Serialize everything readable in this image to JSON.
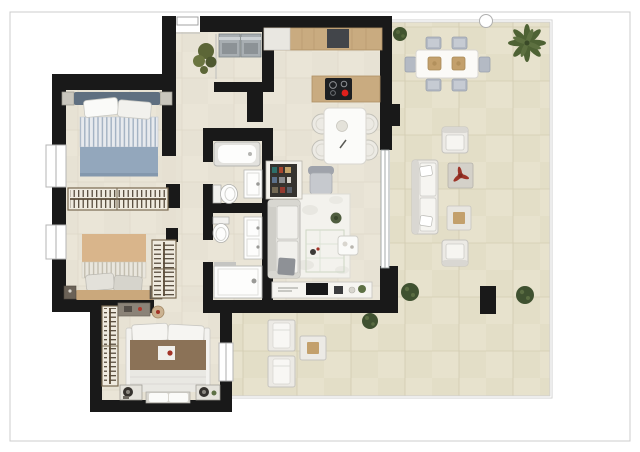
{
  "page": {
    "kind": "apartment-floor-plan-render",
    "background": "#ffffff",
    "frame_color": "#cccccc"
  },
  "palette": {
    "wall": "#191919",
    "indoor_floor": "#eae5d7",
    "terrace_floor": "#e7e2cd",
    "wood_counter": "#c9ab80",
    "wardrobe_wood": "#4a3e30",
    "bed_blue": "#93a7bc",
    "bed_blue_stripe": "#a3b2c3",
    "bed_tan": "#d9b58b",
    "bed_brown": "#8b7257",
    "fixture_white": "#fdfdfc",
    "furniture_gray": "#c6c9ce",
    "outdoor_white": "#eceae5",
    "plant_green": "#41542f",
    "plant_olive": "#5c6637",
    "accent_red": "#e0201c",
    "deco_red": "#9c3428",
    "appliance_gray": "#a8aeb2",
    "glass_line": "#9aa0a0",
    "balustrade": "#cfcfcf",
    "tv_black": "#17181a",
    "cooktop_black": "#1d1f22"
  },
  "plan": {
    "rooms": [
      {
        "id": "entry-hall",
        "items": [
          "entry-door",
          "potted-plant"
        ]
      },
      {
        "id": "utility-closet",
        "items": [
          "washer",
          "dryer"
        ]
      },
      {
        "id": "kitchen",
        "items": [
          "wall-counter",
          "sink-unit",
          "island-with-cooktop"
        ]
      },
      {
        "id": "dining-area",
        "items": [
          "table",
          "four-round-chairs",
          "armchair"
        ]
      },
      {
        "id": "living-room",
        "items": [
          "sofa",
          "rug",
          "side-table",
          "bookshelf",
          "tv-sideboard",
          "glass-sliding-door"
        ]
      },
      {
        "id": "bedroom-1",
        "items": [
          "double-bed-blue",
          "two-nightstands",
          "wardrobe",
          "window"
        ]
      },
      {
        "id": "bedroom-2",
        "items": [
          "double-bed-tan",
          "two-nightstands",
          "wardrobe",
          "window"
        ]
      },
      {
        "id": "master-bedroom",
        "items": [
          "double-bed-brown",
          "bench",
          "two-nightstands",
          "wardrobe",
          "desk",
          "stool",
          "window"
        ]
      },
      {
        "id": "bathroom-1",
        "items": [
          "bathtub",
          "washbasin",
          "toilet"
        ]
      },
      {
        "id": "bathroom-2",
        "items": [
          "shower",
          "washbasin",
          "toilet"
        ]
      },
      {
        "id": "terrace",
        "items": [
          "outdoor-dining-table",
          "six-chairs",
          "outdoor-sofa",
          "two-outdoor-armchairs",
          "coffee-table",
          "side-table",
          "two-loungers",
          "lounger-table",
          "potted-plants",
          "palm-tree",
          "pillar",
          "glass-balustrade"
        ]
      }
    ]
  }
}
